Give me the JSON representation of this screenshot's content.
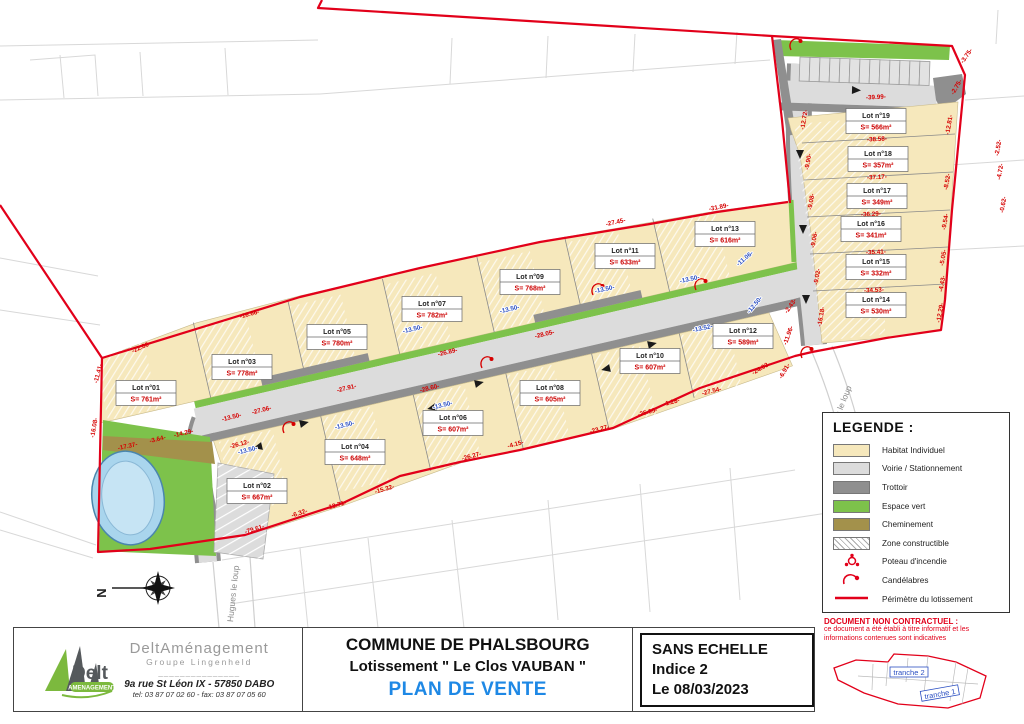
{
  "north_label": "N",
  "legend": {
    "title": "LEGENDE :",
    "items": [
      {
        "label": "Habitat Individuel",
        "type": "habitat"
      },
      {
        "label": "Voirie / Stationnement",
        "type": "voirie"
      },
      {
        "label": "Trottoir",
        "type": "trottoir"
      },
      {
        "label": "Espace vert",
        "type": "espace"
      },
      {
        "label": "Cheminement",
        "type": "cheminement"
      },
      {
        "label": "Zone constructible",
        "type": "zone"
      },
      {
        "label": "Poteau d'incendie",
        "type": "poteau"
      },
      {
        "label": "Candélabres",
        "type": "candelabre"
      },
      {
        "label": "Périmètre du lotissement",
        "type": "perimetre"
      }
    ]
  },
  "title_block": {
    "company": {
      "brand": "Delt",
      "brand_sub": "AMENAGEMENT",
      "name": "DeltAménagement",
      "group": "Groupe Lingenheld",
      "separator": "_______________",
      "address": "9a rue St Léon IX - 57850 DABO",
      "phone": "tel: 03 87 07 02 60 - fax: 03 87 07 05 60"
    },
    "project": {
      "commune": "COMMUNE DE PHALSBOURG",
      "lotissement": "Lotissement \" Le Clos VAUBAN \"",
      "plan": "PLAN DE VENTE"
    },
    "info": {
      "scale": "SANS ECHELLE",
      "indice": "Indice 2",
      "date": "Le 08/03/2023"
    },
    "disclaimer": {
      "title": "DOCUMENT NON CONTRACTUEL :",
      "line1": "ce document a été établi à titre informatif et les",
      "line2": "informations contenues sont indicatives"
    },
    "inset": {
      "t1": "tranche 1",
      "t2": "tranche 2"
    }
  },
  "road_names": [
    {
      "t": "Hugues le loup",
      "x": 236,
      "y": 594,
      "r": -84
    },
    {
      "t": "es le loup",
      "x": 845,
      "y": 404,
      "r": -68
    }
  ],
  "lots": [
    {
      "name": "Lot n°01",
      "area": "S= 761m²",
      "x": 146,
      "y": 393
    },
    {
      "name": "Lot n°02",
      "area": "S= 667m²",
      "x": 257,
      "y": 491
    },
    {
      "name": "Lot n°03",
      "area": "S= 778m²",
      "x": 242,
      "y": 367
    },
    {
      "name": "Lot n°04",
      "area": "S= 648m²",
      "x": 355,
      "y": 452
    },
    {
      "name": "Lot n°05",
      "area": "S= 780m²",
      "x": 337,
      "y": 337
    },
    {
      "name": "Lot n°06",
      "area": "S= 607m²",
      "x": 453,
      "y": 423
    },
    {
      "name": "Lot n°07",
      "area": "S= 782m²",
      "x": 432,
      "y": 309
    },
    {
      "name": "Lot n°08",
      "area": "S= 605m²",
      "x": 550,
      "y": 393
    },
    {
      "name": "Lot n°09",
      "area": "S= 768m²",
      "x": 530,
      "y": 282
    },
    {
      "name": "Lot n°10",
      "area": "S= 607m²",
      "x": 650,
      "y": 361
    },
    {
      "name": "Lot n°11",
      "area": "S= 633m²",
      "x": 625,
      "y": 256
    },
    {
      "name": "Lot n°12",
      "area": "S= 589m²",
      "x": 743,
      "y": 336
    },
    {
      "name": "Lot n°13",
      "area": "S= 616m²",
      "x": 725,
      "y": 234
    },
    {
      "name": "Lot n°14",
      "area": "S= 530m²",
      "x": 876,
      "y": 305
    },
    {
      "name": "Lot n°15",
      "area": "S= 332m²",
      "x": 876,
      "y": 267
    },
    {
      "name": "Lot n°16",
      "area": "S= 341m²",
      "x": 871,
      "y": 229
    },
    {
      "name": "Lot n°17",
      "area": "S= 349m²",
      "x": 877,
      "y": 196
    },
    {
      "name": "Lot n°18",
      "area": "S= 357m²",
      "x": 878,
      "y": 159
    },
    {
      "name": "Lot n°19",
      "area": "S= 566m²",
      "x": 876,
      "y": 121
    }
  ],
  "dims": [
    {
      "t": "-22.86-",
      "x": 142,
      "y": 349,
      "r": -24,
      "c": "r"
    },
    {
      "t": "-11.41-",
      "x": 100,
      "y": 374,
      "r": -75,
      "c": "r"
    },
    {
      "t": "-16.08-",
      "x": 96,
      "y": 428,
      "r": -80,
      "c": "r"
    },
    {
      "t": "-17.37-",
      "x": 128,
      "y": 448,
      "r": -12,
      "c": "r"
    },
    {
      "t": "-3.64-",
      "x": 158,
      "y": 441,
      "r": -14,
      "c": "r"
    },
    {
      "t": "-14.29-",
      "x": 184,
      "y": 435,
      "r": -14,
      "c": "r"
    },
    {
      "t": "-16.66-",
      "x": 250,
      "y": 316,
      "r": -15,
      "c": "r"
    },
    {
      "t": "-13.50-",
      "x": 232,
      "y": 419,
      "r": -14,
      "c": "r"
    },
    {
      "t": "-27.06-",
      "x": 262,
      "y": 412,
      "r": -14,
      "c": "r"
    },
    {
      "t": "-26.12-",
      "x": 240,
      "y": 446,
      "r": -15,
      "c": "r"
    },
    {
      "t": "-27.91-",
      "x": 347,
      "y": 390,
      "r": -14,
      "c": "r"
    },
    {
      "t": "-28.60-",
      "x": 430,
      "y": 390,
      "r": -14,
      "c": "r"
    },
    {
      "t": "-26.89-",
      "x": 448,
      "y": 354,
      "r": -13,
      "c": "r"
    },
    {
      "t": "-28.05-",
      "x": 545,
      "y": 336,
      "r": -13,
      "c": "r"
    },
    {
      "t": "-27.45-",
      "x": 616,
      "y": 224,
      "r": -12,
      "c": "r"
    },
    {
      "t": "-31.89-",
      "x": 719,
      "y": 209,
      "r": -11,
      "c": "r"
    },
    {
      "t": "-20.91-",
      "x": 742,
      "y": 241,
      "r": -28,
      "c": "r"
    },
    {
      "t": "-79.61-",
      "x": 255,
      "y": 531,
      "r": -17,
      "c": "r"
    },
    {
      "t": "-6.32-",
      "x": 300,
      "y": 515,
      "r": -18,
      "c": "r"
    },
    {
      "t": "-13.71-",
      "x": 337,
      "y": 507,
      "r": -16,
      "c": "r"
    },
    {
      "t": "-15.32-",
      "x": 385,
      "y": 491,
      "r": -16,
      "c": "r"
    },
    {
      "t": "-26.27-",
      "x": 472,
      "y": 458,
      "r": -15,
      "c": "r"
    },
    {
      "t": "-4.15-",
      "x": 516,
      "y": 446,
      "r": -15,
      "c": "r"
    },
    {
      "t": "-23.27-",
      "x": 600,
      "y": 431,
      "r": -15,
      "c": "r"
    },
    {
      "t": "-25.05-",
      "x": 648,
      "y": 414,
      "r": -15,
      "c": "r"
    },
    {
      "t": "-27.54-",
      "x": 712,
      "y": 393,
      "r": -14,
      "c": "r"
    },
    {
      "t": "-1.28-",
      "x": 672,
      "y": 404,
      "r": -15,
      "c": "r"
    },
    {
      "t": "-24.03-",
      "x": 762,
      "y": 370,
      "r": -30,
      "c": "r"
    },
    {
      "t": "-11.96-",
      "x": 790,
      "y": 336,
      "r": -70,
      "c": "r"
    },
    {
      "t": "-2.43-",
      "x": 792,
      "y": 307,
      "r": -55,
      "c": "r"
    },
    {
      "t": "-6.91-",
      "x": 786,
      "y": 372,
      "r": -60,
      "c": "r"
    },
    {
      "t": "-39.99-",
      "x": 876,
      "y": 99,
      "r": -3,
      "c": "r"
    },
    {
      "t": "-38.58-",
      "x": 877,
      "y": 141,
      "r": -3,
      "c": "r"
    },
    {
      "t": "-37.17-",
      "x": 877,
      "y": 179,
      "r": -3,
      "c": "r"
    },
    {
      "t": "-36.29-",
      "x": 871,
      "y": 216,
      "r": -3,
      "c": "r"
    },
    {
      "t": "-35.41-",
      "x": 876,
      "y": 254,
      "r": -3,
      "c": "r"
    },
    {
      "t": "-34.53-",
      "x": 874,
      "y": 292,
      "r": -3,
      "c": "r"
    },
    {
      "t": "-2.75-",
      "x": 958,
      "y": 88,
      "r": -60,
      "c": "r"
    },
    {
      "t": "-12.81-",
      "x": 951,
      "y": 125,
      "r": -80,
      "c": "r"
    },
    {
      "t": "-8.52-",
      "x": 949,
      "y": 182,
      "r": -80,
      "c": "r"
    },
    {
      "t": "-9.54-",
      "x": 947,
      "y": 222,
      "r": -80,
      "c": "r"
    },
    {
      "t": "-5.05-",
      "x": 945,
      "y": 258,
      "r": -80,
      "c": "r"
    },
    {
      "t": "-4.43-",
      "x": 944,
      "y": 284,
      "r": -80,
      "c": "r"
    },
    {
      "t": "-12.29-",
      "x": 942,
      "y": 313,
      "r": -80,
      "c": "r"
    },
    {
      "t": "-2.52-",
      "x": 1000,
      "y": 148,
      "r": -80,
      "c": "r"
    },
    {
      "t": "-4.72-",
      "x": 1002,
      "y": 172,
      "r": -80,
      "c": "r"
    },
    {
      "t": "-0.62-",
      "x": 1005,
      "y": 205,
      "r": -80,
      "c": "r"
    },
    {
      "t": "-3.75-",
      "x": 968,
      "y": 57,
      "r": -55,
      "c": "r"
    },
    {
      "t": "-12.72-",
      "x": 806,
      "y": 120,
      "r": -80,
      "c": "r"
    },
    {
      "t": "-9.90-",
      "x": 810,
      "y": 162,
      "r": -80,
      "c": "r"
    },
    {
      "t": "-9.08-",
      "x": 813,
      "y": 202,
      "r": -80,
      "c": "r"
    },
    {
      "t": "-9.06-",
      "x": 816,
      "y": 240,
      "r": -80,
      "c": "r"
    },
    {
      "t": "-9.02-",
      "x": 819,
      "y": 277,
      "r": -80,
      "c": "r"
    },
    {
      "t": "-16.18-",
      "x": 823,
      "y": 317,
      "r": -80,
      "c": "r"
    },
    {
      "t": "-13.50-",
      "x": 248,
      "y": 452,
      "r": -14,
      "c": "b"
    },
    {
      "t": "-13.50-",
      "x": 345,
      "y": 427,
      "r": -14,
      "c": "b"
    },
    {
      "t": "-13.50-",
      "x": 443,
      "y": 407,
      "r": -14,
      "c": "b"
    },
    {
      "t": "-13.50-",
      "x": 540,
      "y": 387,
      "r": -13,
      "c": "b"
    },
    {
      "t": "-13.50-",
      "x": 637,
      "y": 367,
      "r": -12,
      "c": "b"
    },
    {
      "t": "-13.50-",
      "x": 413,
      "y": 331,
      "r": -13,
      "c": "b"
    },
    {
      "t": "-13.50-",
      "x": 510,
      "y": 311,
      "r": -13,
      "c": "b"
    },
    {
      "t": "-13.50-",
      "x": 605,
      "y": 291,
      "r": -12,
      "c": "b"
    },
    {
      "t": "-13.50-",
      "x": 690,
      "y": 281,
      "r": -12,
      "c": "b"
    },
    {
      "t": "-13.52-",
      "x": 703,
      "y": 330,
      "r": -12,
      "c": "b"
    },
    {
      "t": "-12.50-",
      "x": 756,
      "y": 306,
      "r": -50,
      "c": "b"
    },
    {
      "t": "-11.06-",
      "x": 746,
      "y": 260,
      "r": -40,
      "c": "b"
    }
  ],
  "arrows": [
    {
      "x": 300,
      "y": 424,
      "r": -13
    },
    {
      "x": 475,
      "y": 384,
      "r": -13
    },
    {
      "x": 648,
      "y": 345,
      "r": -13
    },
    {
      "x": 262,
      "y": 446,
      "r": 167
    },
    {
      "x": 436,
      "y": 407,
      "r": 167
    },
    {
      "x": 610,
      "y": 368,
      "r": 167
    },
    {
      "x": 800,
      "y": 150,
      "r": 90
    },
    {
      "x": 803,
      "y": 225,
      "r": 90
    },
    {
      "x": 806,
      "y": 295,
      "r": 90
    },
    {
      "x": 852,
      "y": 90,
      "r": 2
    }
  ],
  "candelabras": [
    {
      "x": 288,
      "y": 425
    },
    {
      "x": 486,
      "y": 360
    },
    {
      "x": 597,
      "y": 287
    },
    {
      "x": 700,
      "y": 282
    },
    {
      "x": 795,
      "y": 42
    },
    {
      "x": 806,
      "y": 350
    }
  ]
}
